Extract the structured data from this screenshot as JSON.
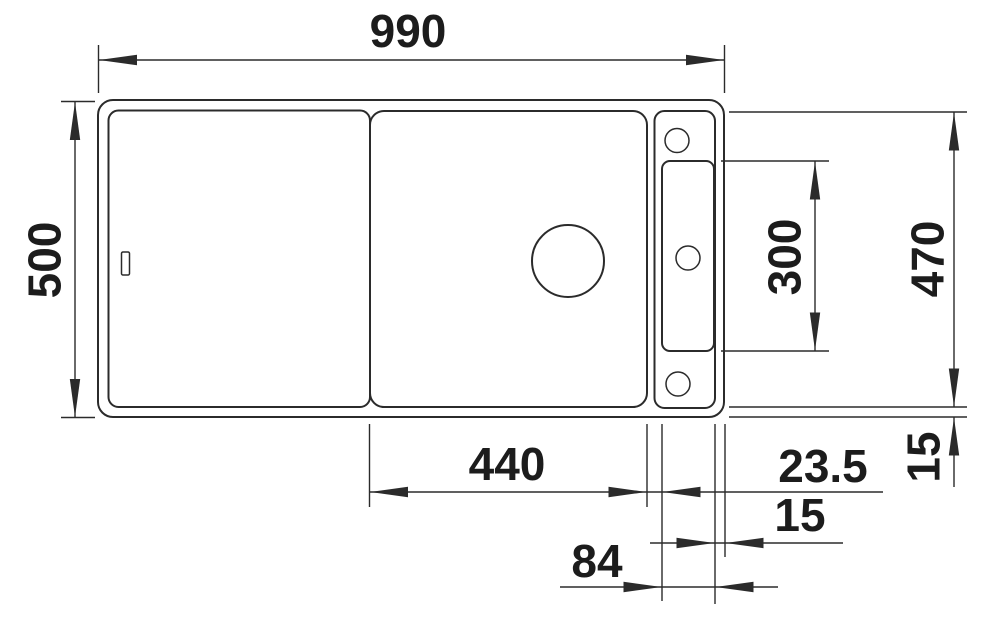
{
  "drawing": {
    "type": "technical-dimension-drawing",
    "subject": "kitchen sink top view with dimension lines",
    "colors": {
      "line": "#2b2b2b",
      "text": "#1c1c1c",
      "background": "#ffffff"
    },
    "dims": {
      "overall_width": "990",
      "overall_depth": "500",
      "inner_depth": "470",
      "tap_panel_height": "300",
      "bowl_width": "440",
      "bowl_to_panel": "23.5",
      "rim_right": "15",
      "tap_panel_width": "84",
      "rim_bottom": "15"
    }
  }
}
